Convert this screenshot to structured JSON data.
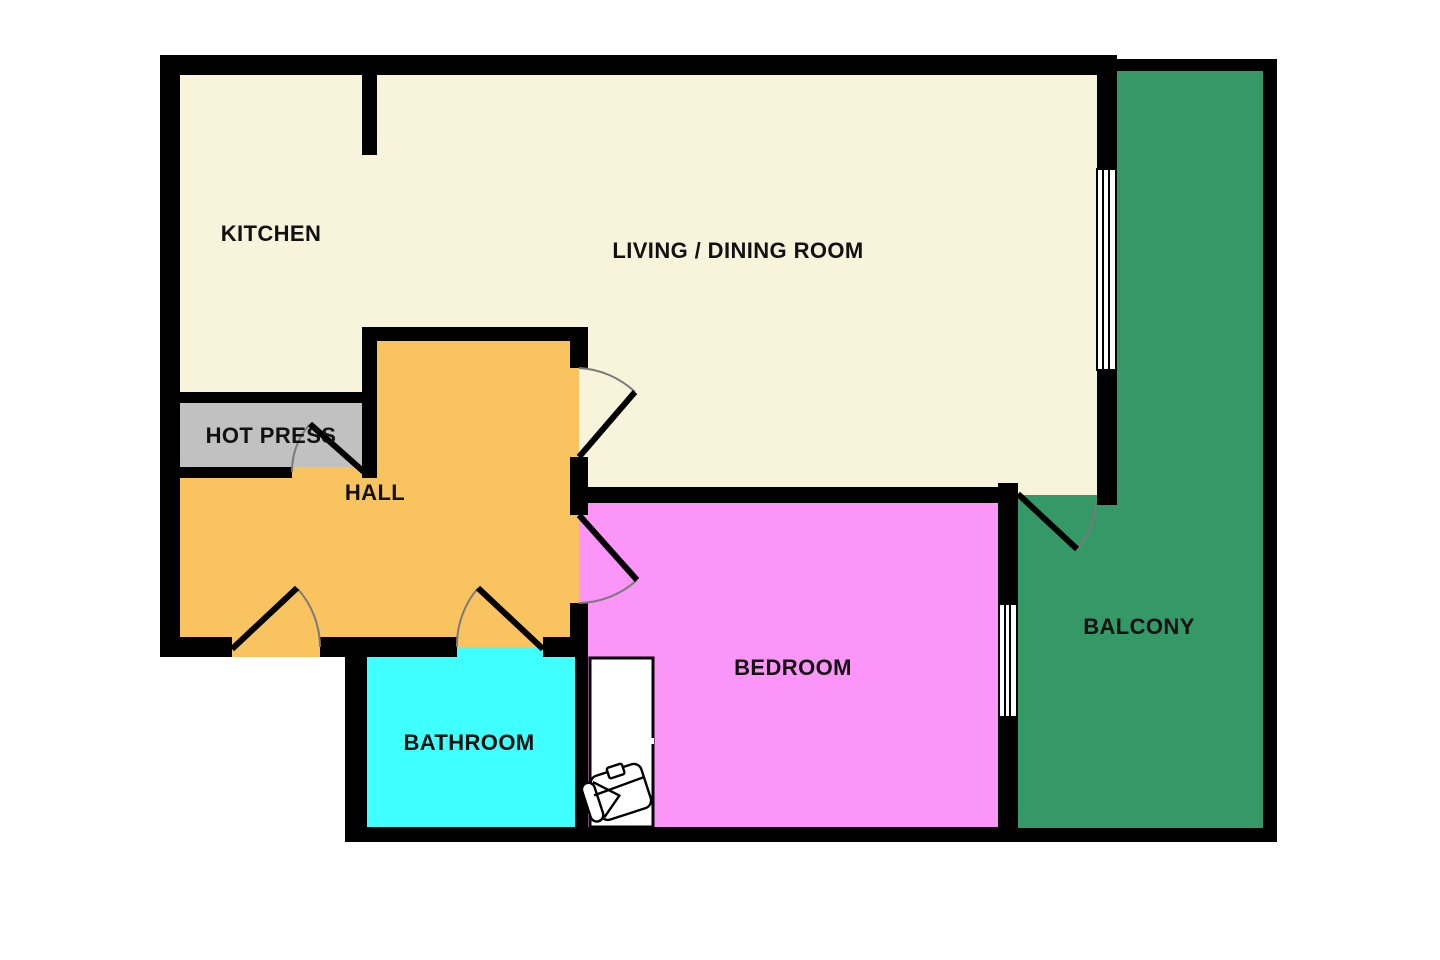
{
  "palette": {
    "background": "#FFFFFF",
    "walls": "#000000",
    "door_arc": "#7A7A7A",
    "window_fill": "#FFFFFF",
    "kitchen_living_floor": "#F8F4DC",
    "hall_floor": "#F9C45F",
    "hot_press_floor": "#C1C1C1",
    "bathroom_floor": "#3FFFFF",
    "bedroom_floor": "#FB95F7",
    "balcony_floor": "#349966"
  },
  "rooms": [
    {
      "id": "kitchen",
      "label": "KITCHEN",
      "floor_color": "#F8F4DC"
    },
    {
      "id": "living_dining_room",
      "label": "LIVING / DINING ROOM",
      "floor_color": "#F8F4DC"
    },
    {
      "id": "hot_press",
      "label": "HOT PRESS",
      "floor_color": "#C1C1C1"
    },
    {
      "id": "hall",
      "label": "HALL",
      "floor_color": "#F9C45F"
    },
    {
      "id": "bathroom",
      "label": "BATHROOM",
      "floor_color": "#3FFFFF"
    },
    {
      "id": "bedroom",
      "label": "BEDROOM",
      "floor_color": "#FB95F7"
    },
    {
      "id": "balcony",
      "label": "BALCONY",
      "floor_color": "#349966"
    }
  ],
  "features": {
    "doors": [
      {
        "name": "entrance-door",
        "location": "hall south wall"
      },
      {
        "name": "hot-press-door",
        "location": "hot press south wall"
      },
      {
        "name": "bathroom-door",
        "location": "bathroom north wall"
      },
      {
        "name": "living-room-door",
        "location": "hall east wall"
      },
      {
        "name": "bedroom-door",
        "location": "bedroom west wall"
      },
      {
        "name": "balcony-door",
        "location": "living room south wall"
      }
    ],
    "windows": [
      {
        "name": "living-room-window",
        "location": "living room east wall"
      },
      {
        "name": "bedroom-window",
        "location": "bedroom east wall"
      }
    ],
    "furniture": [
      {
        "name": "single-bed",
        "room": "bedroom"
      }
    ]
  }
}
